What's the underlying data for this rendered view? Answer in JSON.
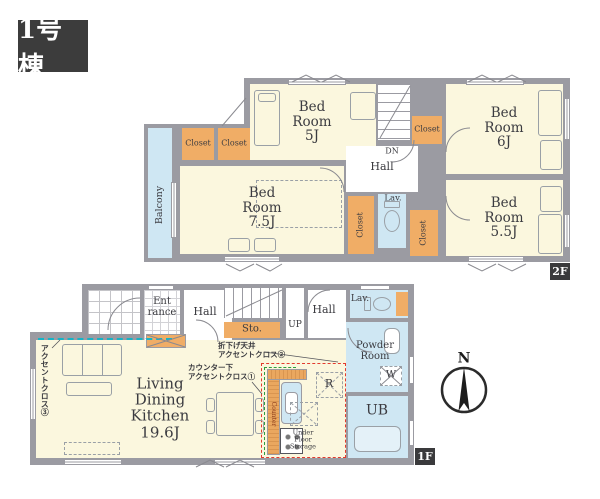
{
  "building_label": "1号棟",
  "compass": {
    "north": "N"
  },
  "colors": {
    "wall": "#9b9ba2",
    "room": "#fbf7de",
    "closet": "#f0ad66",
    "water": "#cfe7f3",
    "badge": "#3a3a3c",
    "accent_red": "#e23b2e",
    "accent_green": "#2e9e3e",
    "accent_teal": "#15b4c6"
  },
  "f2": {
    "badge": "2F",
    "balcony": "Balcony",
    "dn": "DN",
    "hall": "Hall",
    "lav": "Lav.",
    "closets": {
      "c1": "Closet",
      "c2": "Closet",
      "c3": "Closet",
      "c4": "Closet",
      "c5": "Closet"
    },
    "bed5": [
      "Bed",
      "Room",
      "5J"
    ],
    "bed6": [
      "Bed",
      "Room",
      "6J"
    ],
    "bed75": [
      "Bed",
      "Room",
      "7.5J"
    ],
    "bed55": [
      "Bed",
      "Room",
      "5.5J"
    ]
  },
  "f1": {
    "badge": "1F",
    "entrance": [
      "Ent",
      "rance"
    ],
    "hall_front": "Hall",
    "hall_center": "Hall",
    "sto": "Sto.",
    "up": "UP",
    "lav": "Lav.",
    "powder": [
      "Powder",
      "Room"
    ],
    "ldk": [
      "Living",
      "Dining",
      "Kitchen",
      "19.6J"
    ],
    "ub": "UB",
    "fridge": "R",
    "washer": "W",
    "under_floor_storage": [
      "Under",
      "Floor",
      "Storage"
    ],
    "counter": "Counter",
    "annotations": {
      "accent_wall_3": "アクセントクロス③",
      "accent_counter": [
        "カウンター下",
        "アクセントクロス①"
      ],
      "accent_ceiling": [
        "折下げ天井",
        "アクセントクロス②"
      ]
    }
  }
}
